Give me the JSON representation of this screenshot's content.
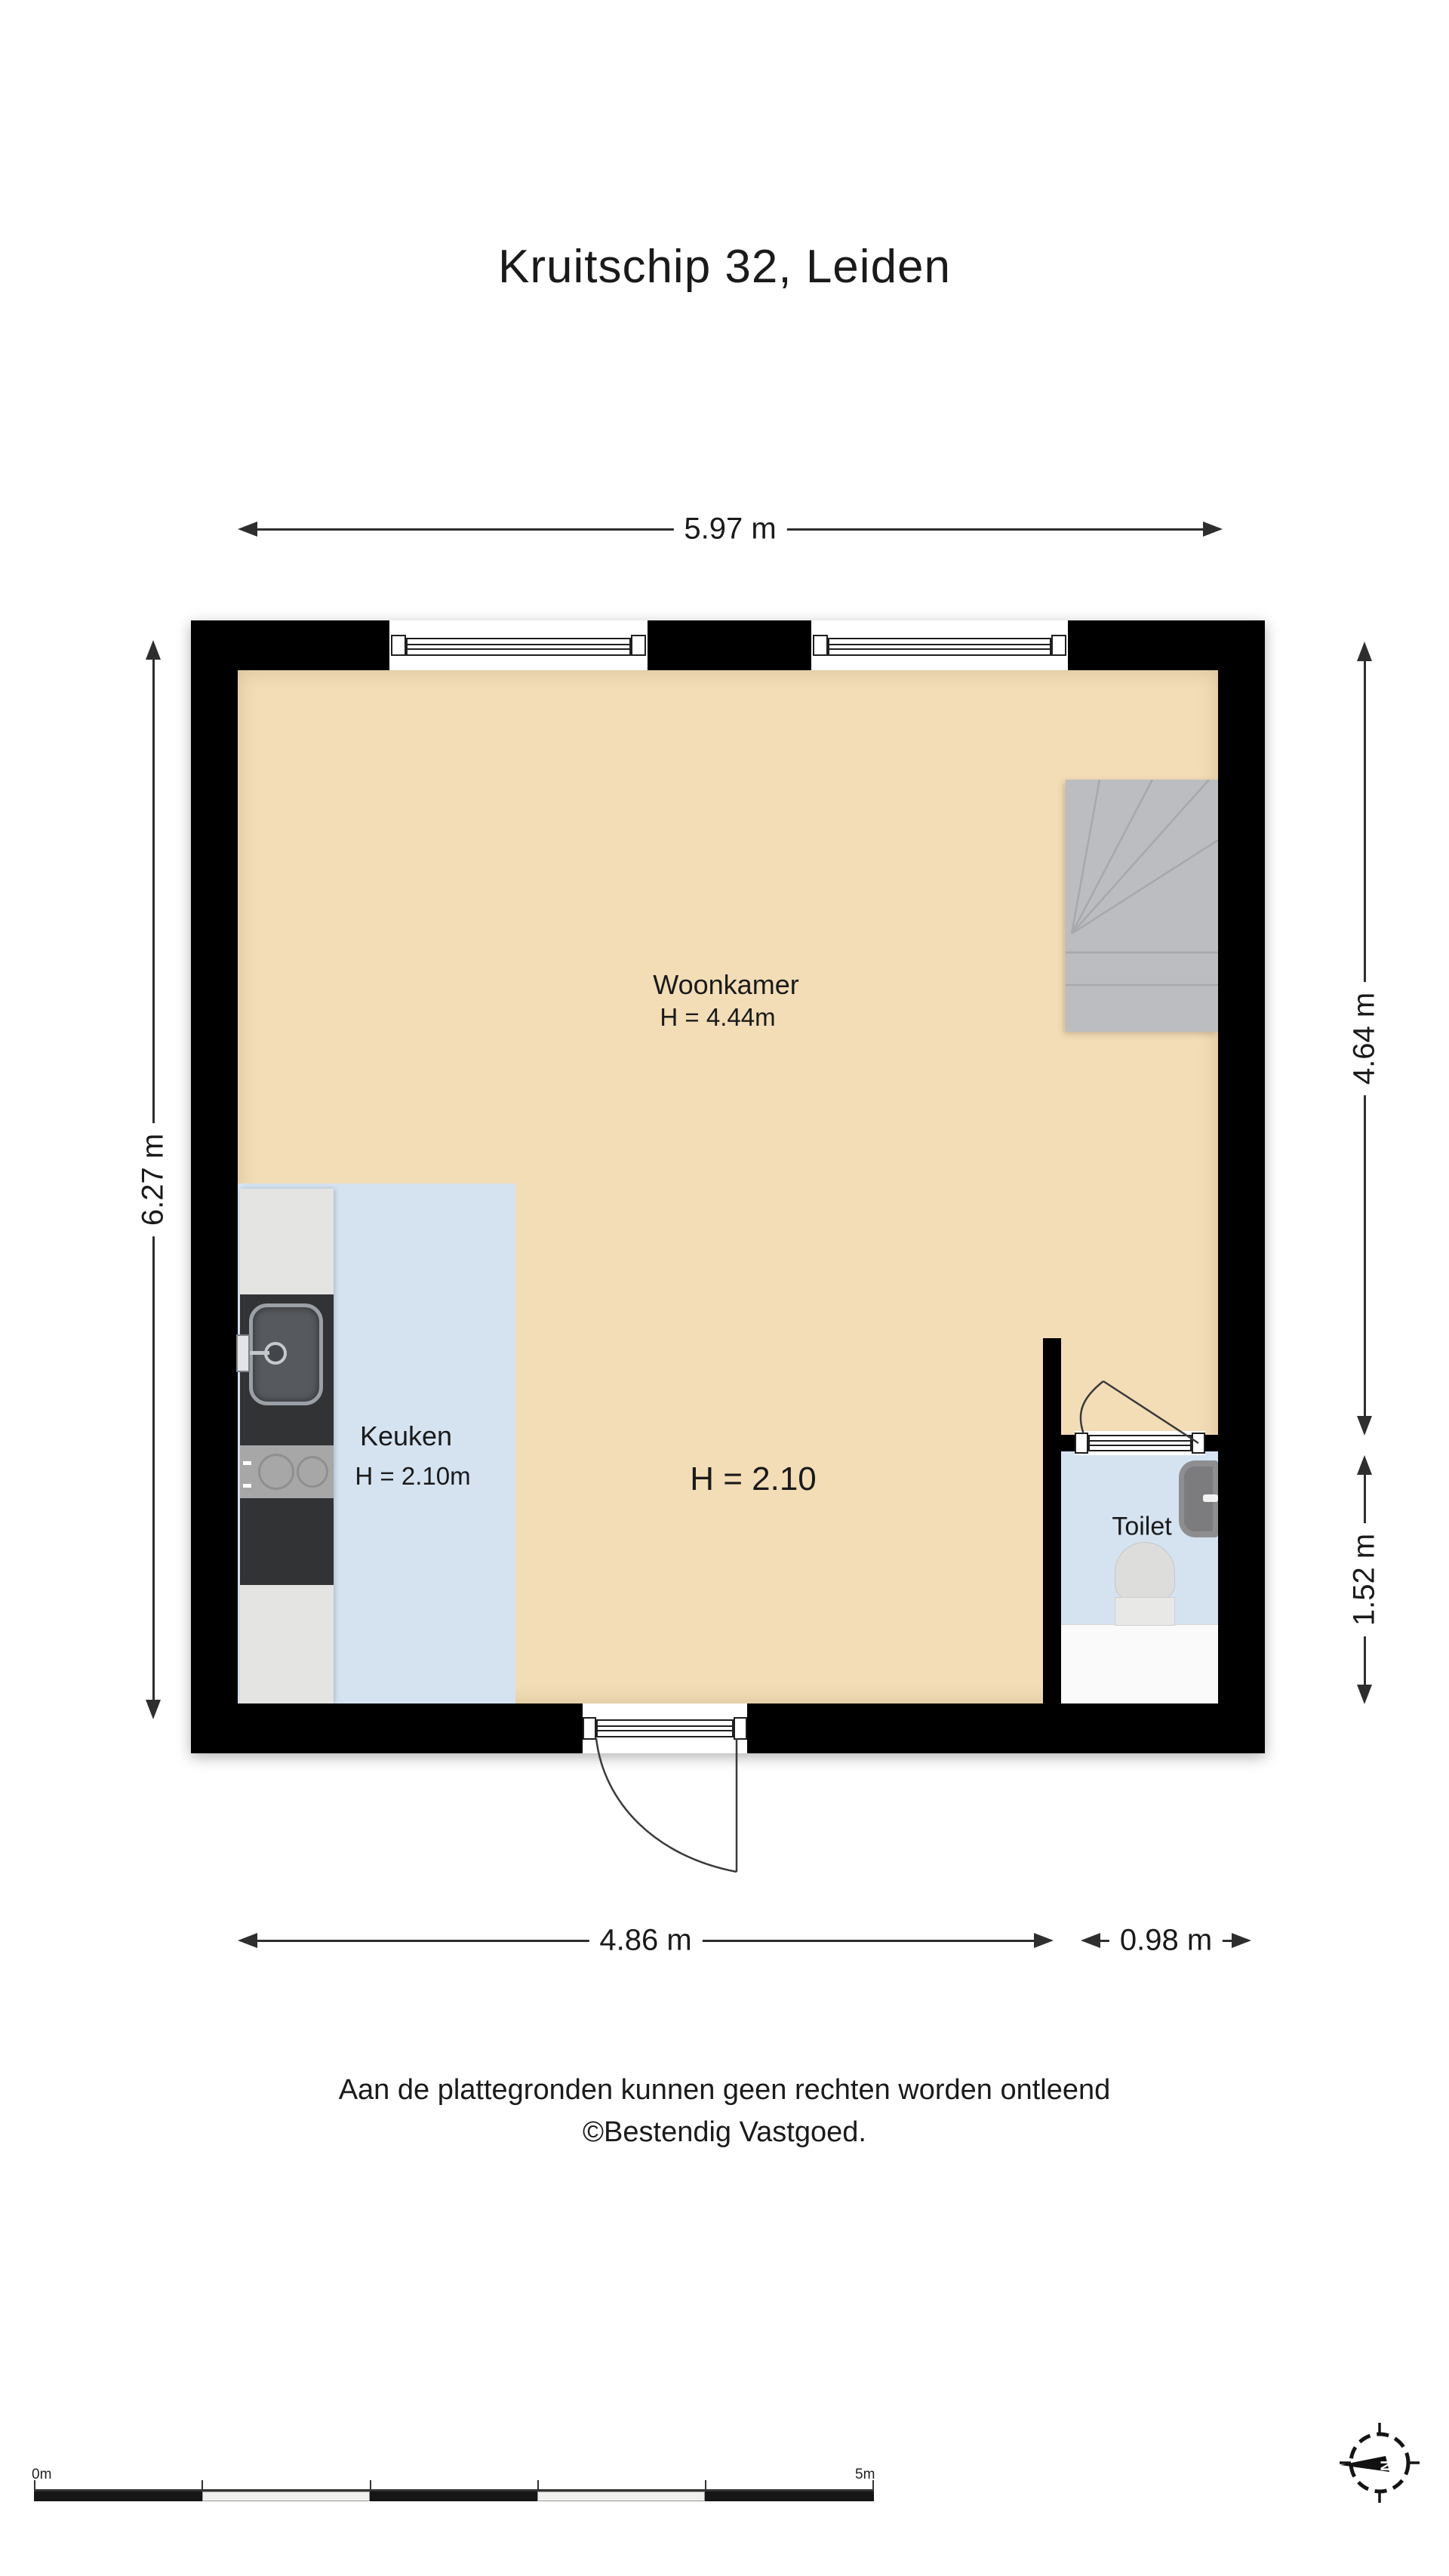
{
  "title": "Kruitschip 32, Leiden",
  "rooms": {
    "woonkamer": {
      "name": "Woonkamer",
      "height": "H = 4.44m"
    },
    "keuken": {
      "name": "Keuken",
      "height": "H = 2.10m"
    },
    "toilet": {
      "name": "Toilet"
    },
    "ceiling_note": "H = 2.10"
  },
  "dimensions": {
    "top": "5.97 m",
    "left": "6.27 m",
    "right_upper": "4.64 m",
    "right_lower": "1.52 m",
    "bottom_left": "4.86 m",
    "bottom_right": "0.98 m"
  },
  "scale_bar": {
    "start": "0m",
    "end": "5m"
  },
  "compass": {
    "north": "N"
  },
  "footer": {
    "line1": "Aan de plattegronden kunnen geen rechten worden ontleend",
    "line2": "©Bestendig Vastgoed."
  },
  "colors": {
    "wall": "#000000",
    "floor_living": "#f3ddb6",
    "floor_wet": "#d5e3f1",
    "stairs": "#bcbdc0",
    "counter_dark": "#323335",
    "counter_light": "#e4e4e2"
  }
}
